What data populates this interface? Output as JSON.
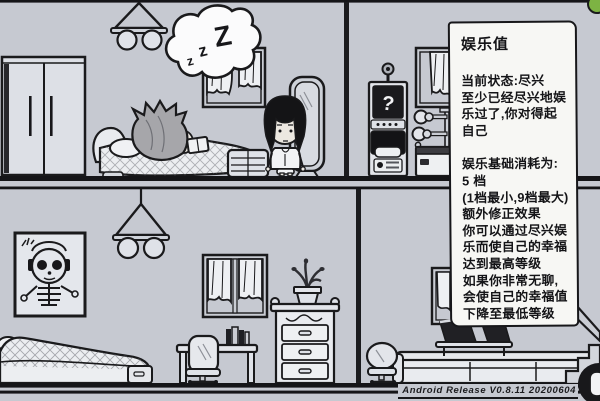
{
  "panel": {
    "title": "娱乐值",
    "status_lines": [
      "当前状态:尽兴",
      "至少已经尽兴地娱",
      "乐过了,你对得起",
      "自己"
    ],
    "detail_lines": [
      "娱乐基础消耗为:",
      "5 档",
      "(1档最小,9档最大)",
      "额外修正效果",
      "你可以通过尽兴娱",
      "乐而使自己的幸福",
      "达到最高等级",
      "如果你非常无聊,",
      "会使自己的幸福值",
      "下降至最低等级"
    ]
  },
  "scene": {
    "bubble": {
      "z1": "z",
      "z2": "z",
      "z3": "Z"
    },
    "arcade_screen": "?"
  },
  "footer": {
    "version": "Android Release V0.8.11 20200604"
  },
  "colors": {
    "wall": "#c6c9d1",
    "outline": "#1a1a1c",
    "panel_bg": "#f7f7f4",
    "dark": "#17171a",
    "fill_light": "#e6e8ec",
    "fill_white": "#f2f3f5",
    "green": "#7db343",
    "hair_gray": "#a6a6aa",
    "skin": "#ece8e1"
  }
}
